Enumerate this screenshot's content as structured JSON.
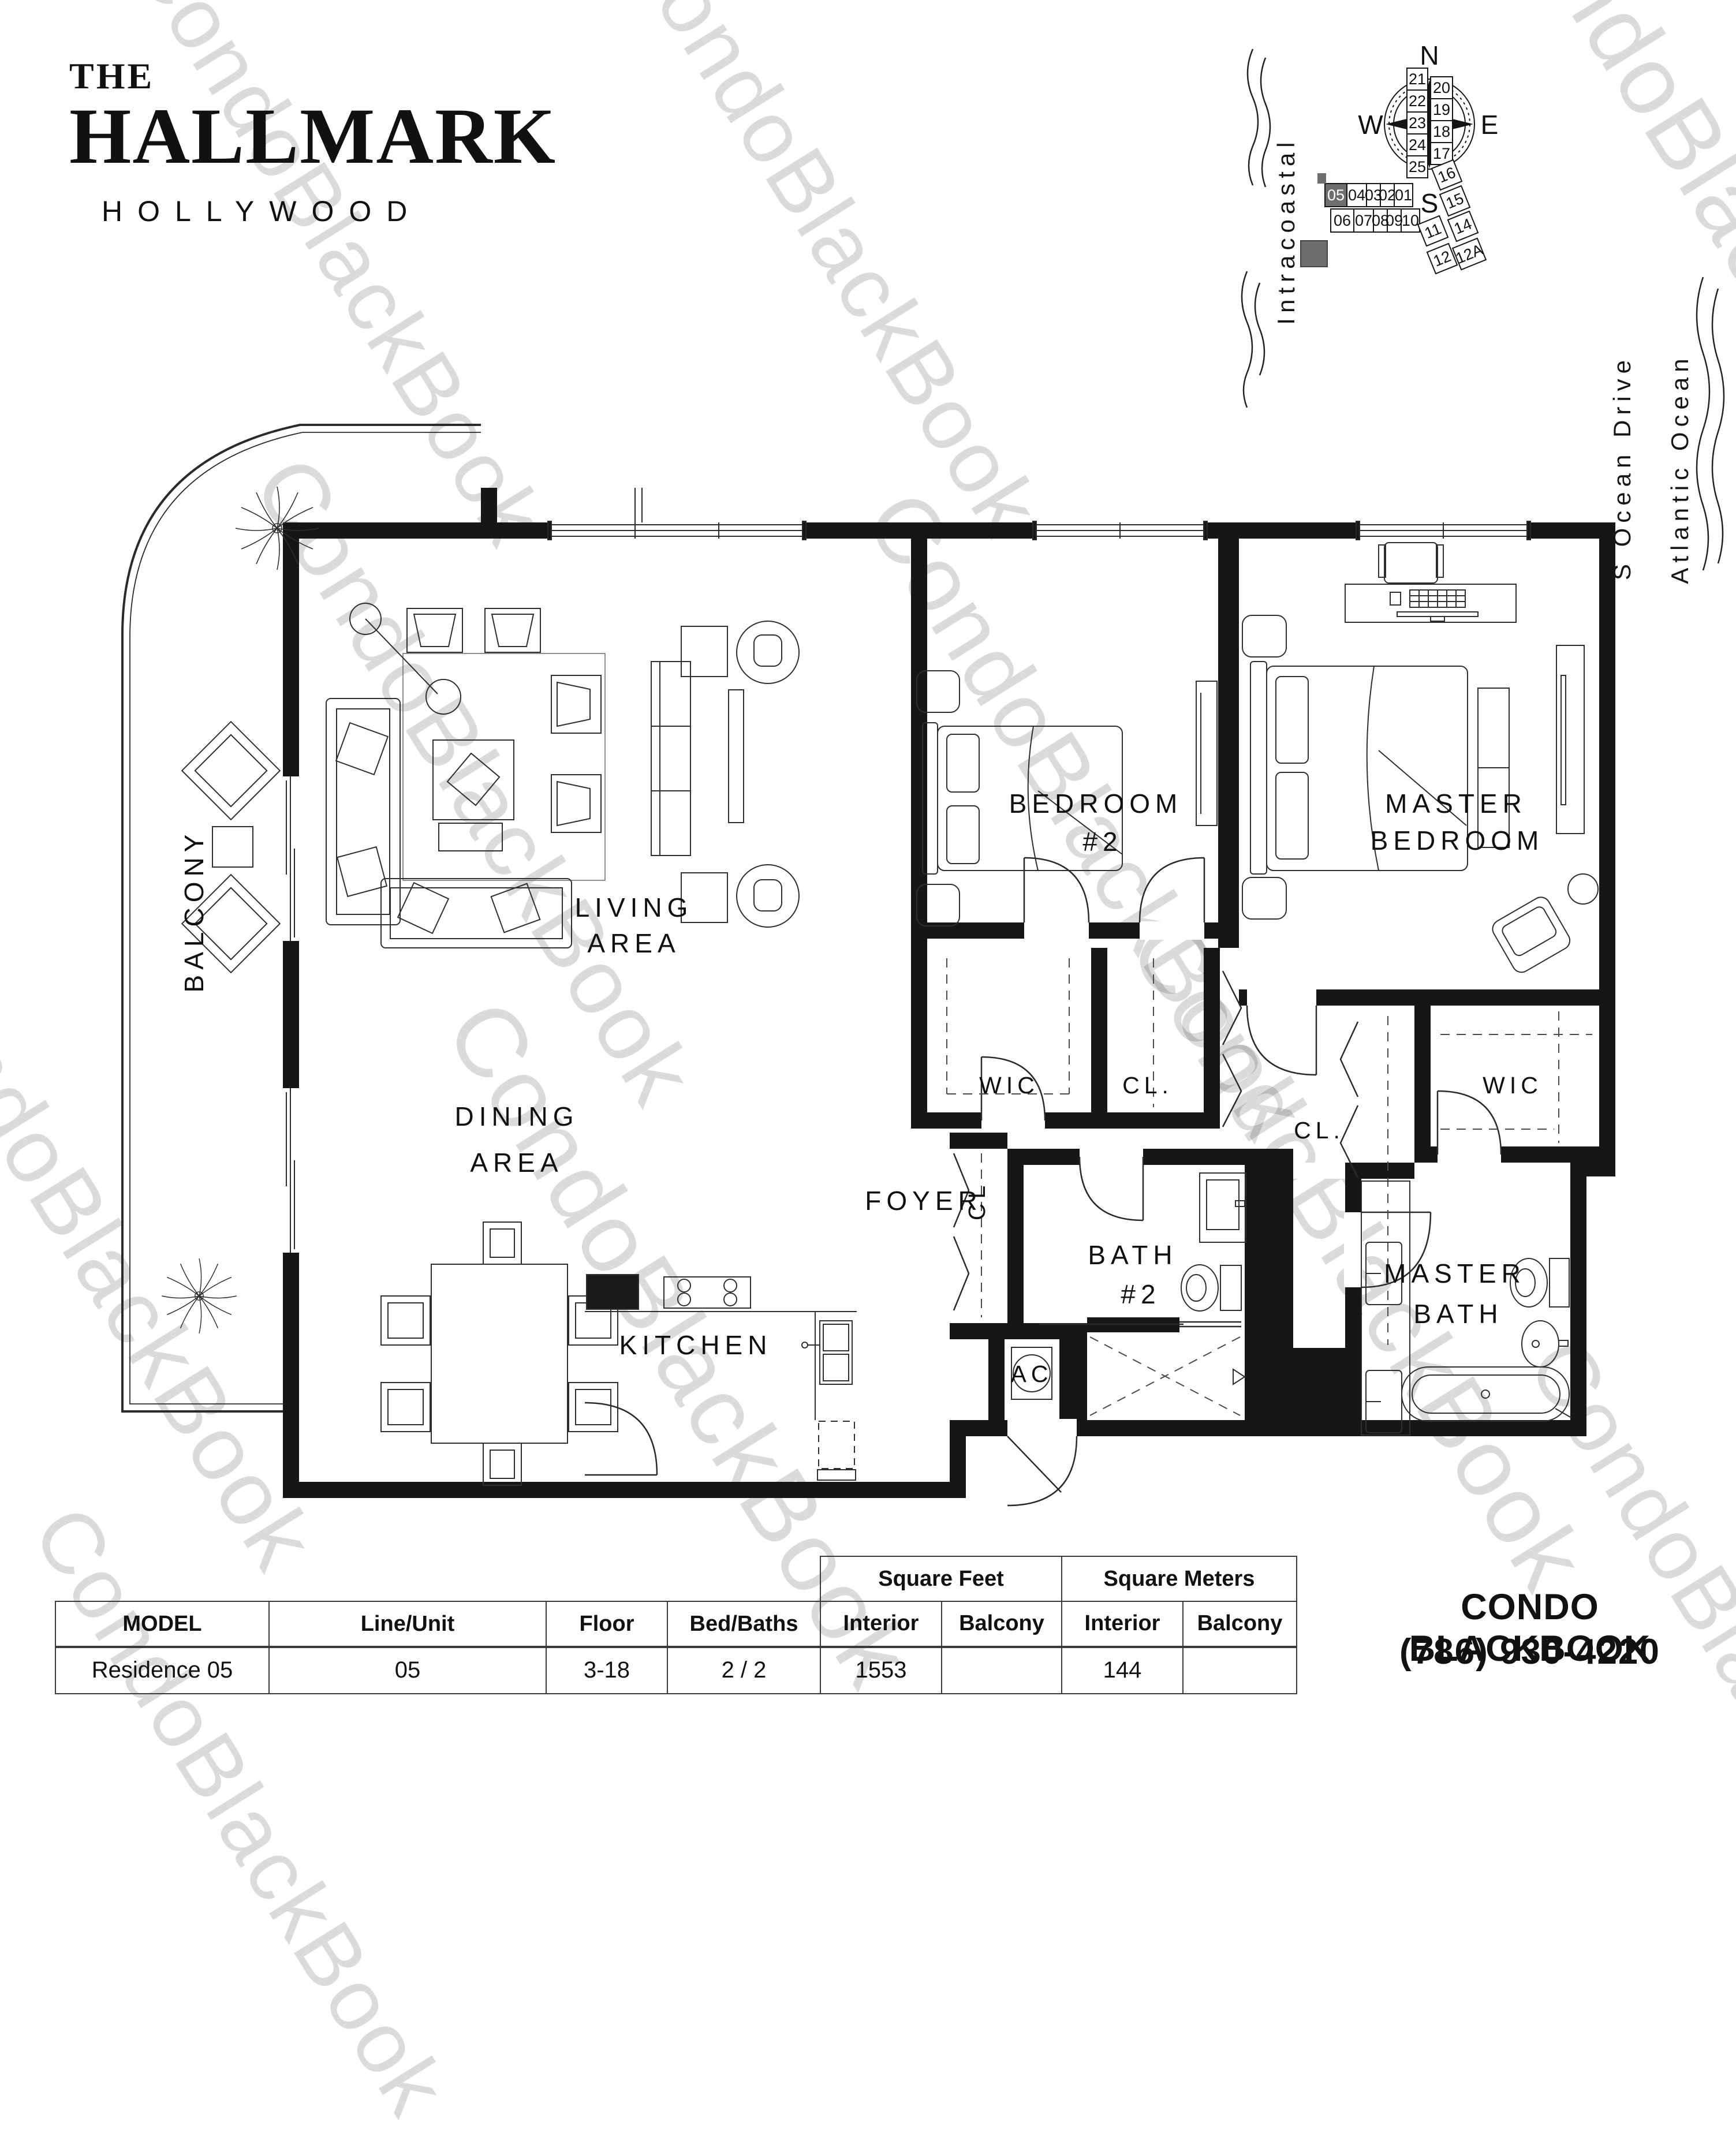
{
  "watermark": {
    "text": "CondoBlackBook"
  },
  "header": {
    "pre": "THE",
    "title": "HALLMARK",
    "subtitle": "HOLLYWOOD"
  },
  "sitemap": {
    "compass": {
      "n": "N",
      "e": "E",
      "s": "S",
      "w": "W"
    },
    "streets": {
      "intracoastal": "Intracoastal",
      "ocean_drive": "S Ocean Drive",
      "atlantic": "Atlantic Ocean"
    },
    "units": {
      "col_left": [
        "21",
        "22",
        "23",
        "24",
        "25"
      ],
      "col_right": [
        "20",
        "19",
        "18",
        "17"
      ],
      "row_top": [
        "05",
        "04",
        "03",
        "02",
        "01"
      ],
      "row_bottom": [
        "06",
        "07",
        "08",
        "09",
        "10"
      ],
      "diagonal": [
        "16",
        "15",
        "14",
        "11",
        "12",
        "12A"
      ]
    },
    "highlighted_unit": "05",
    "highlight_color": "#6e6e6e"
  },
  "floorplan": {
    "labels": {
      "balcony": "BALCONY",
      "living1": "LIVING",
      "living2": "AREA",
      "dining1": "DINING",
      "dining2": "AREA",
      "kitchen": "KITCHEN",
      "foyer": "FOYER",
      "foyer_closet": "CL",
      "bedroom2_1": "BEDROOM",
      "bedroom2_2": "#2",
      "bedroom2_wic": "WIC",
      "bedroom2_closet": "CL.",
      "hall_closet": "CL.",
      "master1": "MASTER",
      "master2": "BEDROOM",
      "master_wic": "WIC",
      "bath2_1": "BATH",
      "bath2_2": "#2",
      "masterbath1": "MASTER",
      "masterbath2": "BATH",
      "ac": "AC"
    }
  },
  "table": {
    "group_sqft": "Square Feet",
    "group_sqm": "Square Meters",
    "h_model": "MODEL",
    "h_line": "Line/Unit",
    "h_floor": "Floor",
    "h_bed": "Bed/Baths",
    "h_interior": "Interior",
    "h_balcony": "Balcony",
    "h_interior2": "Interior",
    "h_balcony2": "Balcony",
    "v_model": "Residence 05",
    "v_line": "05",
    "v_floor": "3-18",
    "v_bed": "2 / 2",
    "v_sf_interior": "1553",
    "v_sf_balcony": "",
    "v_sm_interior": "144",
    "v_sm_balcony": ""
  },
  "footer": {
    "brand": "CONDO BLACKBOOK",
    "phone": "(786) 930-4220"
  }
}
